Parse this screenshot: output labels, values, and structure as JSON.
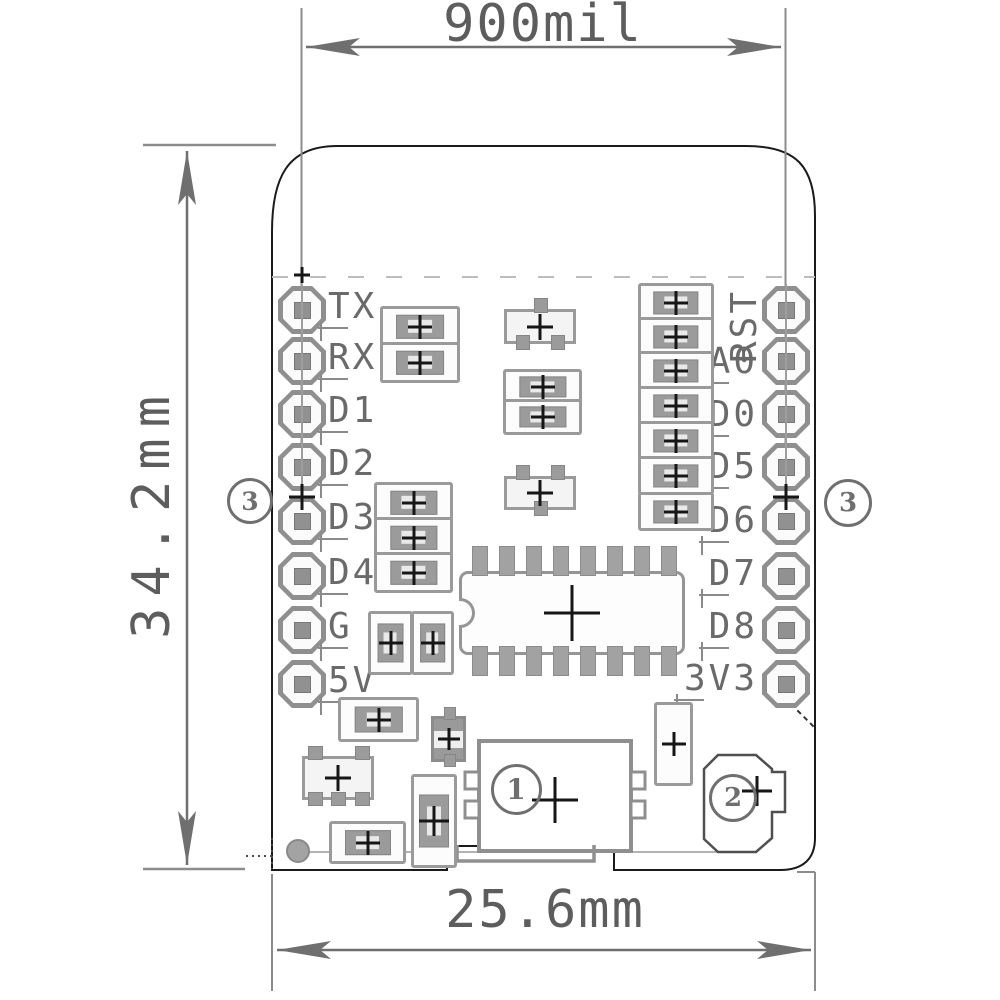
{
  "dimensions": {
    "top": "900mil",
    "side": "34.2mm",
    "bottom": "25.6mm"
  },
  "pins": {
    "left": [
      {
        "label": "TX",
        "y": 310
      },
      {
        "label": "RX",
        "y": 361
      },
      {
        "label": "D1",
        "y": 414
      },
      {
        "label": "D2",
        "y": 467
      },
      {
        "label": "D3",
        "y": 521
      },
      {
        "label": "D4",
        "y": 576
      },
      {
        "label": "G",
        "y": 630
      },
      {
        "label": "5V",
        "y": 684
      }
    ],
    "right": [
      {
        "label": "RST",
        "y": 326,
        "rot": true
      },
      {
        "label": "A0",
        "y": 365
      },
      {
        "label": "D0",
        "y": 418
      },
      {
        "label": "D5",
        "y": 470
      },
      {
        "label": "D6",
        "y": 524
      },
      {
        "label": "D7",
        "y": 577
      },
      {
        "label": "D8",
        "y": 630
      },
      {
        "label": "3V3",
        "y": 682
      }
    ]
  },
  "pads": {
    "columns_x": [
      302,
      786
    ],
    "rows_y": [
      310,
      361,
      414,
      467,
      521,
      576,
      630,
      684
    ],
    "size": 48
  },
  "callouts": [
    {
      "n": "3",
      "x": 247,
      "y": 498,
      "d": 40
    },
    {
      "n": "3",
      "x": 845,
      "y": 500,
      "d": 42
    },
    {
      "n": "1",
      "x": 513,
      "y": 786,
      "d": 45
    },
    {
      "n": "2",
      "x": 730,
      "y": 795,
      "d": 42
    }
  ],
  "crosshairs": [
    {
      "x": 302,
      "y": 497,
      "s": 26
    },
    {
      "x": 786,
      "y": 497,
      "s": 26
    },
    {
      "x": 555,
      "y": 800,
      "s": 46
    },
    {
      "x": 757,
      "y": 791,
      "s": 30
    },
    {
      "x": 302,
      "y": 275,
      "s": 16
    }
  ],
  "components": [
    {
      "t": "resh",
      "x": 380,
      "y": 306,
      "w": 74,
      "h": 35
    },
    {
      "t": "resh",
      "x": 380,
      "y": 342,
      "w": 74,
      "h": 35
    },
    {
      "t": "resh",
      "x": 503,
      "y": 369,
      "w": 73,
      "h": 30
    },
    {
      "t": "resh",
      "x": 503,
      "y": 399,
      "w": 73,
      "h": 30
    },
    {
      "t": "resh",
      "x": 374,
      "y": 482,
      "w": 73,
      "h": 35
    },
    {
      "t": "resh",
      "x": 374,
      "y": 517,
      "w": 73,
      "h": 35
    },
    {
      "t": "resh",
      "x": 374,
      "y": 552,
      "w": 73,
      "h": 35
    },
    {
      "t": "resh",
      "x": 638,
      "y": 283,
      "w": 70,
      "h": 33
    },
    {
      "t": "resh",
      "x": 638,
      "y": 317,
      "w": 70,
      "h": 33
    },
    {
      "t": "resh",
      "x": 638,
      "y": 351,
      "w": 70,
      "h": 33
    },
    {
      "t": "resh",
      "x": 638,
      "y": 386,
      "w": 70,
      "h": 33
    },
    {
      "t": "resh",
      "x": 638,
      "y": 421,
      "w": 70,
      "h": 33
    },
    {
      "t": "resh",
      "x": 638,
      "y": 456,
      "w": 70,
      "h": 33
    },
    {
      "t": "resh",
      "x": 638,
      "y": 492,
      "w": 70,
      "h": 33
    },
    {
      "t": "resh",
      "x": 338,
      "y": 697,
      "w": 75,
      "h": 39
    },
    {
      "t": "resh",
      "x": 329,
      "y": 821,
      "w": 71,
      "h": 37
    },
    {
      "t": "resv",
      "x": 368,
      "y": 611,
      "w": 39,
      "h": 58
    },
    {
      "t": "resv",
      "x": 411,
      "y": 611,
      "w": 37,
      "h": 58
    },
    {
      "t": "cap",
      "x": 411,
      "y": 774,
      "w": 40,
      "h": 88
    },
    {
      "t": "box",
      "x": 654,
      "y": 702,
      "w": 33,
      "h": 78
    },
    {
      "t": "sot3u",
      "x": 504,
      "y": 309,
      "w": 66,
      "h": 29
    },
    {
      "t": "sot3d",
      "x": 504,
      "y": 476,
      "w": 66,
      "h": 28
    },
    {
      "t": "sot5",
      "x": 302,
      "y": 756,
      "w": 66,
      "h": 38
    },
    {
      "t": "ic16",
      "x": 459,
      "y": 571,
      "w": 220,
      "h": 78
    },
    {
      "t": "diode",
      "x": 431,
      "y": 716,
      "w": 29,
      "h": 40
    },
    {
      "t": "fid",
      "x": 286,
      "y": 839,
      "w": 20,
      "h": 20
    }
  ],
  "colors": {
    "dimension": "#6f6f6f",
    "extension": "#8c8c8c",
    "outline": "#1a1a1a",
    "component": "#9a9a9a",
    "label": "#6a6a6a"
  }
}
